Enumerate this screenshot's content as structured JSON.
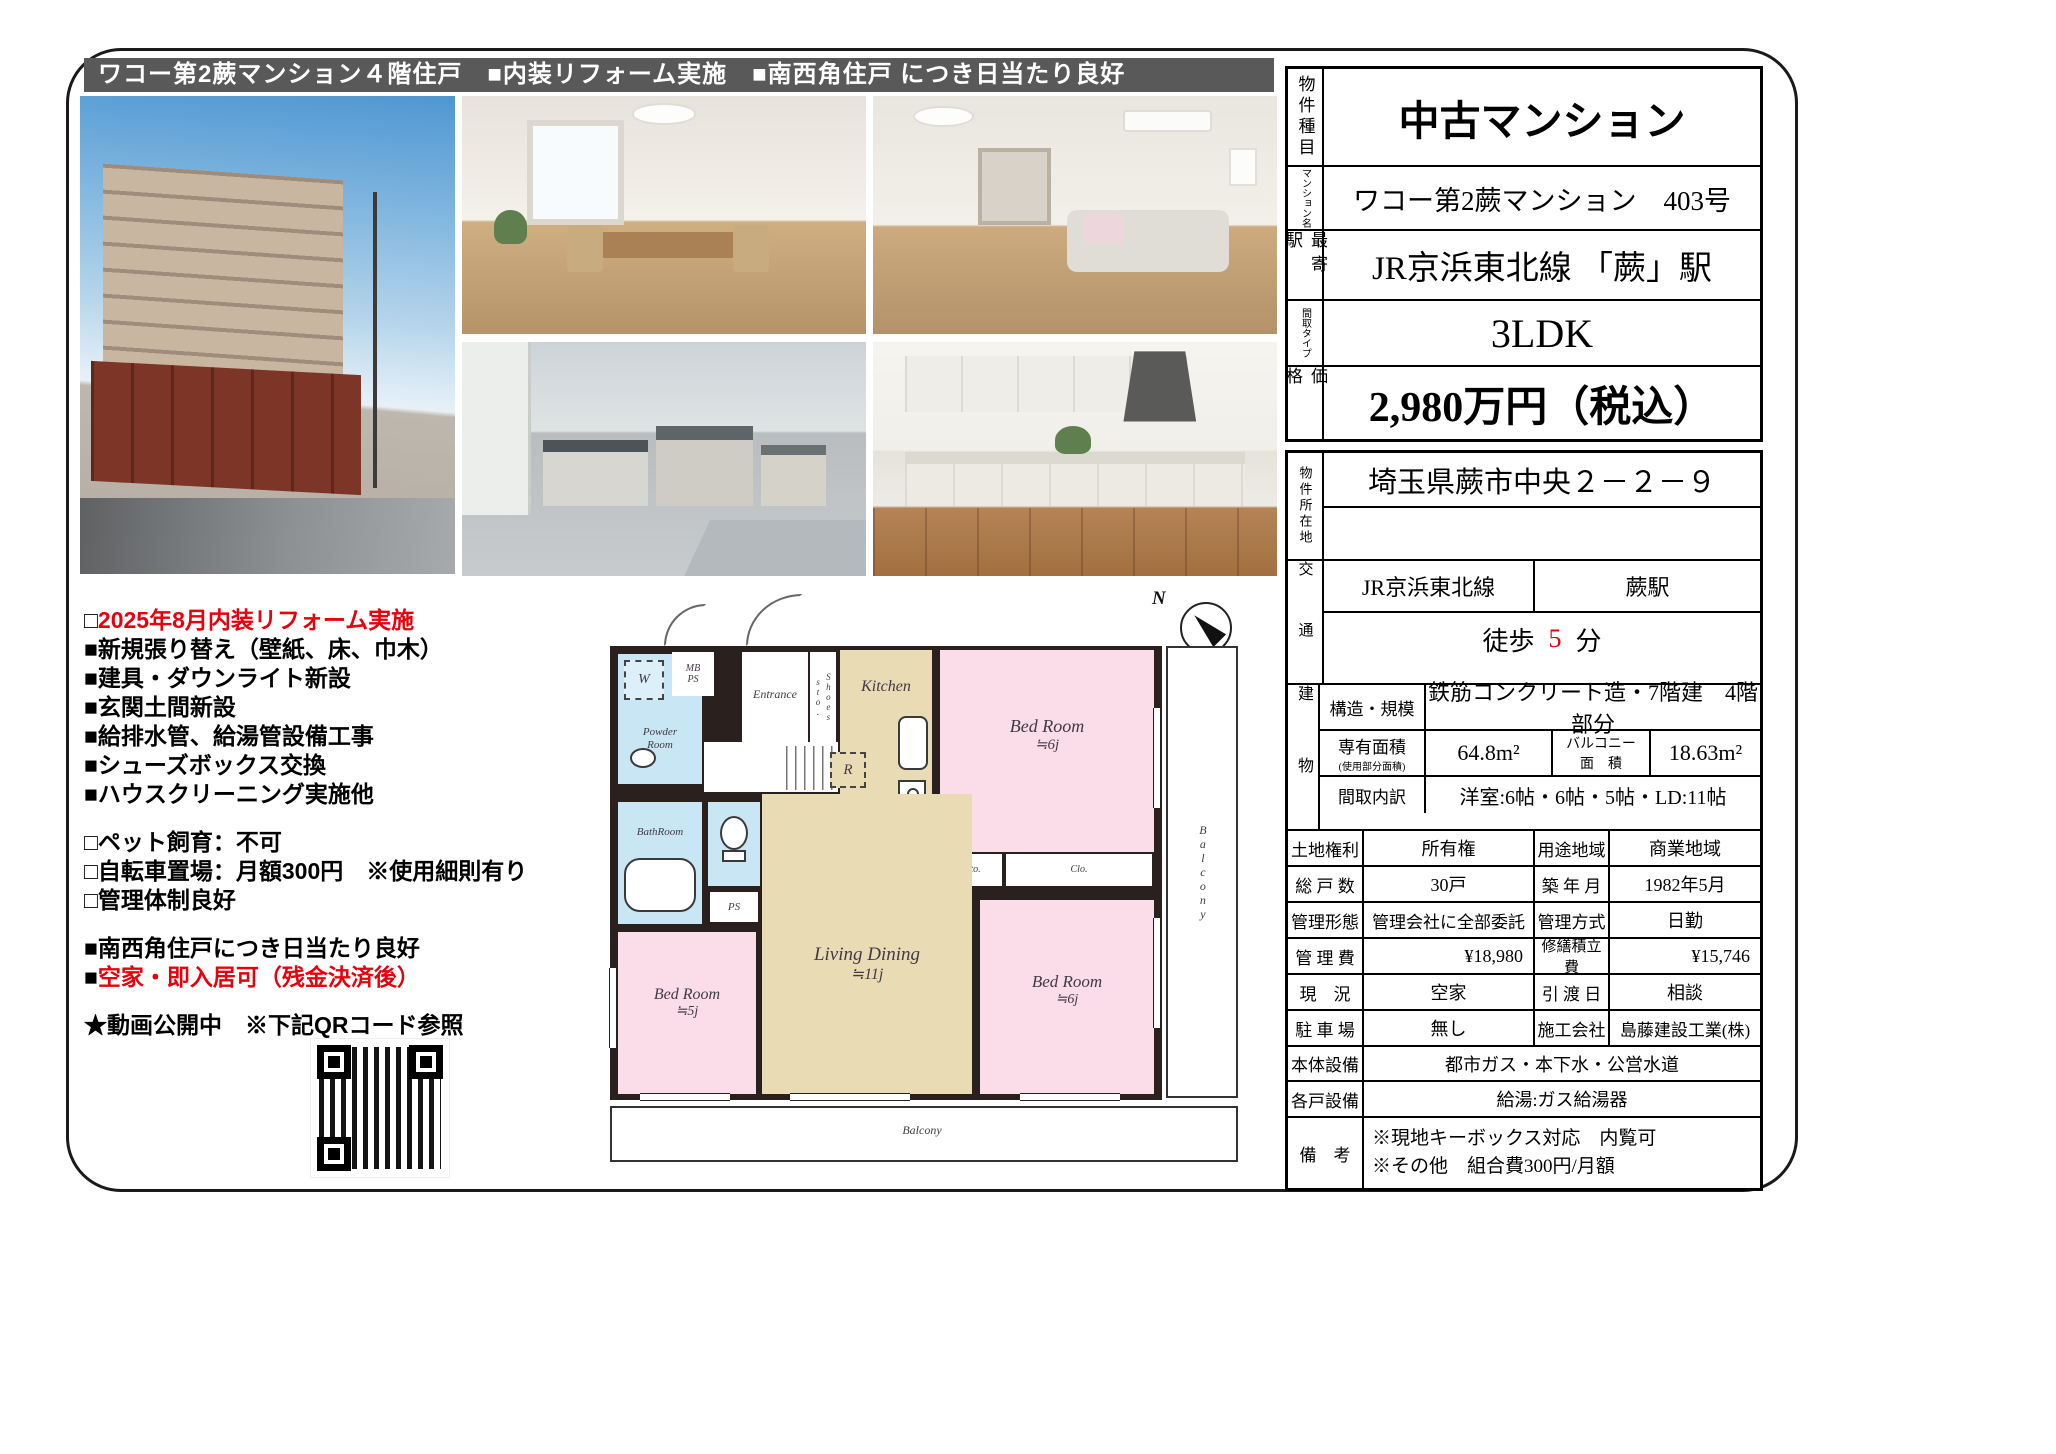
{
  "banner": {
    "text": "ワコー第2蕨マンション４階住戸　■内装リフォーム実施　■南西角住戸 につき日当たり良好"
  },
  "colors": {
    "banner_bg": "#595959",
    "accent_red": "#e8000d",
    "room_pink": "#fbdce9",
    "room_tan": "#e9dbb4",
    "room_blue": "#c9e6f5",
    "wall_dark": "#2a211f"
  },
  "notes": {
    "reform_prefix": "□",
    "reform_title": "2025年8月内装リフォーム実施",
    "reform_items": [
      "■新規張り替え（壁紙、床、巾木）",
      "■建具・ダウンライト新設",
      "■玄関土間新設",
      "■給排水管、給湯管設備工事",
      "■シューズボックス交換",
      "■ハウスクリーニング実施他"
    ],
    "rule_items": [
      "□ペット飼育：不可",
      "□自転車置場：月額300円　※使用細則有り",
      "□管理体制良好"
    ],
    "feature_items": [
      "■南西角住戸につき日当たり良好"
    ],
    "vacant_prefix": "■",
    "vacant_text": "空家・即入居可（残金決済後）",
    "video_note": "★動画公開中　※下記QRコード参照"
  },
  "floorplan": {
    "compass_n": "N",
    "labels": {
      "w": "W",
      "mbps": "MB\nPS",
      "entrance": "Entrance",
      "shoes": "Shoes sto.",
      "kitchen": "Kitchen",
      "r": "R",
      "powder": "Powder\nRoom",
      "bath": "BathRoom",
      "toilet_ps": "PS",
      "bed1": "Bed Room",
      "bed1_size": "≒6j",
      "sto": "Sto.",
      "clo": "Clo.",
      "living": "Living Dining",
      "living_size": "≒11j",
      "bed2": "Bed Room",
      "bed2_size": "≒5j",
      "bed3": "Bed Room",
      "bed3_size": "≒6j",
      "balcony_right": "Balcony",
      "balcony_bottom": "Balcony"
    }
  },
  "spec": {
    "item_label": "物件種目",
    "item_value": "中古マンション",
    "name_label": "マンション名",
    "name_value": "ワコー第2蕨マンション　403号",
    "station_label": "最寄駅",
    "station_value": "JR京浜東北線 「蕨」駅",
    "layout_label": "間取タイプ",
    "layout_value": "3LDK",
    "price_label": "価格",
    "price_value": "2,980万円（税込）"
  },
  "detail": {
    "address_label": "物件所在地",
    "address_value": "埼玉県蕨市中央２－２－９",
    "access_label": "交通",
    "access_line": "JR京浜東北線",
    "access_station": "蕨駅",
    "walk_prefix": "徒歩",
    "walk_minutes": "5",
    "walk_suffix": "分",
    "building_label": "建物",
    "structure_label": "構造・規模",
    "structure_value": "鉄筋コンクリート造・7階建　4階部分",
    "area_label": "専有面積",
    "area_sublabel": "(使用部分面積)",
    "area_value": "64.8m²",
    "balcony_label": "バルコニー",
    "balcony_label2": "面　積",
    "balcony_value": "18.63m²",
    "madori_label": "間取内訳",
    "madori_value": "洋室:6帖・6帖・5帖・LD:11帖",
    "rows": [
      {
        "l1": "土地権利",
        "v1": "所有権",
        "l2": "用途地域",
        "v2": "商業地域"
      },
      {
        "l1": "総 戸 数",
        "v1": "30戸",
        "l2": "築 年 月",
        "v2": "1982年5月"
      },
      {
        "l1": "管理形態",
        "v1": "管理会社に全部委託",
        "l2": "管理方式",
        "v2": "日勤"
      },
      {
        "l1": "管 理 費",
        "v1": "¥18,980",
        "l2": "修繕積立費",
        "v2": "¥15,746"
      },
      {
        "l1": "現　況",
        "v1": "空家",
        "l2": "引 渡 日",
        "v2": "相談"
      },
      {
        "l1": "駐 車 場",
        "v1": "無し",
        "l2": "施工会社",
        "v2": "島藤建設工業(株)"
      }
    ],
    "equip_main_label": "本体設備",
    "equip_main_value": "都市ガス・本下水・公営水道",
    "equip_unit_label": "各戸設備",
    "equip_unit_value": "給湯:ガス給湯器",
    "remarks_label": "備　考",
    "remarks_line1": "※現地キーボックス対応　内覧可",
    "remarks_line2": "※その他　組合費300円/月額"
  }
}
